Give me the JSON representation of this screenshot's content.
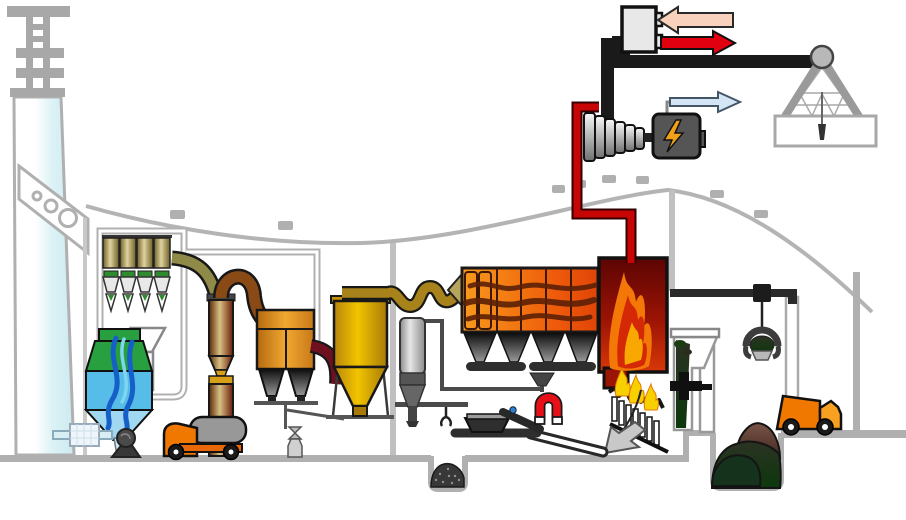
{
  "diagram": {
    "type": "waste-to-energy-plant-process-schematic",
    "text_labels": [],
    "components": [
      {
        "id": "flue-gas-stack",
        "label": "flue gas stack"
      },
      {
        "id": "stack-ladder",
        "label": "stack top ladder"
      },
      {
        "id": "bag-house-filter",
        "label": "bag house filter (4 cells)"
      },
      {
        "id": "wet-scrubber",
        "label": "wet scrubber"
      },
      {
        "id": "scrubber-pump",
        "label": "scrubber circulation pump"
      },
      {
        "id": "water-treatment-box",
        "label": "water treatment box"
      },
      {
        "id": "adsorber-column",
        "label": "adsorber column"
      },
      {
        "id": "spray-absorber",
        "label": "spray absorber with twin hoppers"
      },
      {
        "id": "cyclone-separator",
        "label": "cyclone separator"
      },
      {
        "id": "fly-ash-silo",
        "label": "fly ash silo"
      },
      {
        "id": "electrostatic-precipitator",
        "label": "electrostatic precipitator"
      },
      {
        "id": "furnace",
        "label": "combustion furnace"
      },
      {
        "id": "combustion-grate",
        "label": "inclined combustion grate"
      },
      {
        "id": "ash-discharge-arrow",
        "label": "bottom ash discharge"
      },
      {
        "id": "feed-chute",
        "label": "waste feed chute"
      },
      {
        "id": "ram-feeder",
        "label": "ram feeder"
      },
      {
        "id": "waste-bunker",
        "label": "waste bunker pit"
      },
      {
        "id": "waste-grab",
        "label": "waste grab on crane cable"
      },
      {
        "id": "crane-rail",
        "label": "overhead crane rail"
      },
      {
        "id": "crane-tower",
        "label": "A-frame crane tower"
      },
      {
        "id": "slag-conveyors",
        "label": "slag conveyors"
      },
      {
        "id": "magnetic-separator",
        "label": "magnetic separator"
      },
      {
        "id": "slag-pit",
        "label": "slag pit"
      },
      {
        "id": "steam-turbine",
        "label": "steam turbine"
      },
      {
        "id": "generator",
        "label": "generator"
      },
      {
        "id": "heat-exchanger",
        "label": "district heating heat exchanger"
      },
      {
        "id": "tanker-truck",
        "label": "tanker truck"
      },
      {
        "id": "dump-truck",
        "label": "waste delivery truck"
      }
    ]
  },
  "palette": {
    "building_gray": "#b2b2b2",
    "wall_gray": "#c0c0c0",
    "chimney_fill": "#dbf2f6",
    "filter_green": "#2e8b2e",
    "scrubber_green": "#28a040",
    "scrubber_blue": "#56bce8",
    "scrubber_cone_blue": "#9fd8f0",
    "water_wave_blue": "#1560c8",
    "water_wave_light": "#7fd4f0",
    "olive_pipe": "#8f8a48",
    "arch_pipe_brown": "#8a4a16",
    "gold_band": "#d8a018",
    "maroon_pipe": "#6e1020",
    "flue_pipe_gold": "#a8821a",
    "nozzle_khaki": "#b8a45c",
    "smoke_dark": "#5c2006",
    "flame_orange": "#f47808",
    "flame_red": "#d42806",
    "flame_inner_yellow": "#f8a800",
    "grate_flame_yellow": "#f8d000",
    "ash_arrow_gray": "#c8c8c8",
    "steam_pipe_red": "#c80505",
    "district_pipe_black": "#1a1a1a",
    "hx_gray": "#e8e8e8",
    "arrow_return_pink": "#f8d2bc",
    "arrow_supply_red": "#e00010",
    "arrow_power_blue": "#d4e6f6",
    "generator_gray": "#555555",
    "bolt_yellow": "#f0a018",
    "magnet_red": "#e81018",
    "conveyor_dark": "#2e2e2e",
    "rail_dark": "#2a2a2a",
    "crane_leg_gray": "#9a9a9a",
    "pulley_gray": "#b8b8b8",
    "truck_orange": "#f07800",
    "truck_cab_orange": "#f8a020",
    "tank_gray": "#989898",
    "wheel_black": "#1a1a1a",
    "ash_dark": "#383838",
    "valve_gray": "#bbbbbb",
    "silo_band_gray": "#555555",
    "pump_gray": "#4a4a4a",
    "pipe_water_blue": "#d8edf4",
    "blue_dot": "#2b7fd4"
  }
}
